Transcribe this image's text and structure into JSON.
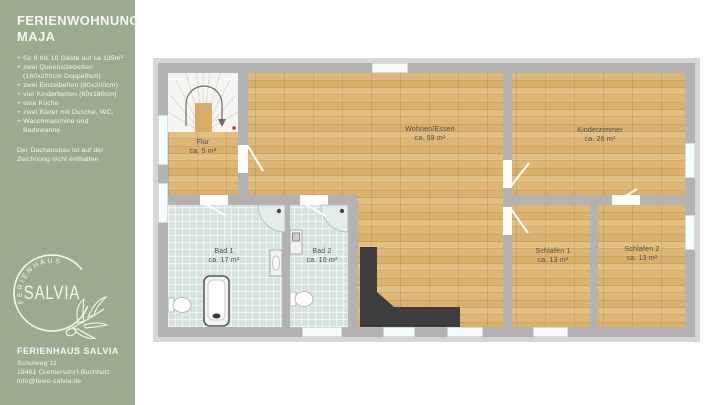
{
  "sidebar": {
    "bg_color": "#9aab8e",
    "title_line1": "FERIENWOHNUNG",
    "title_line2": "MAJA",
    "features": [
      {
        "text": "+ für 8 bis 10 Gäste auf ca 135m²",
        "indent": false
      },
      {
        "text": "+ zwei Queensizebetten",
        "indent": false
      },
      {
        "text": "(160x200cm Doppelbett)",
        "indent": true
      },
      {
        "text": "+ zwei Einzelbetten (80x200cm)",
        "indent": false
      },
      {
        "text": "+ vier Kinderbetten (60x180cm)",
        "indent": false
      },
      {
        "text": "+ eine Küche",
        "indent": false
      },
      {
        "text": "+ zwei Bäder mit Dusche, WC,",
        "indent": false
      },
      {
        "text": "+ Waschmaschine und",
        "indent": false
      },
      {
        "text": "Badewanne",
        "indent": true
      }
    ],
    "note_line1": "Der Dachausbau ist auf der",
    "note_line2": "Zeichnung nicht enthalten",
    "logo": {
      "arc_text": "FERIENHAUS",
      "name": "SALVIA"
    },
    "footer": {
      "title": "FERIENHAUS SALVIA",
      "address_line1": "Schulweg 11",
      "address_line2": "18461 Gremersdorf-Buchholz",
      "email": "info@fewo-salvia.de"
    }
  },
  "floorplan": {
    "rooms": [
      {
        "id": "flur",
        "name": "Flur",
        "area": "ca. 5 m²"
      },
      {
        "id": "wohnen-essen",
        "name": "Wohnen/Essen",
        "area": "ca. 59 m²"
      },
      {
        "id": "kinderzimmer",
        "name": "Kinderzimmer",
        "area": "ca. 26 m²"
      },
      {
        "id": "bad-1",
        "name": "Bad 1",
        "area": "ca. 17 m²"
      },
      {
        "id": "bad-2",
        "name": "Bad 2",
        "area": "ca. 10 m²"
      },
      {
        "id": "schlafen-1",
        "name": "Schlafen 1",
        "area": "ca. 13 m²"
      },
      {
        "id": "schlafen-2",
        "name": "Schlafen 2",
        "area": "ca. 13 m²"
      }
    ],
    "colors": {
      "wood": "#d8b06c",
      "tile": "#d4e3de",
      "wall": "#b2b2b2",
      "counter": "#3d3d3d",
      "stair_marker_red": "#bb3333",
      "sidebar_green": "#9aab8e"
    }
  }
}
